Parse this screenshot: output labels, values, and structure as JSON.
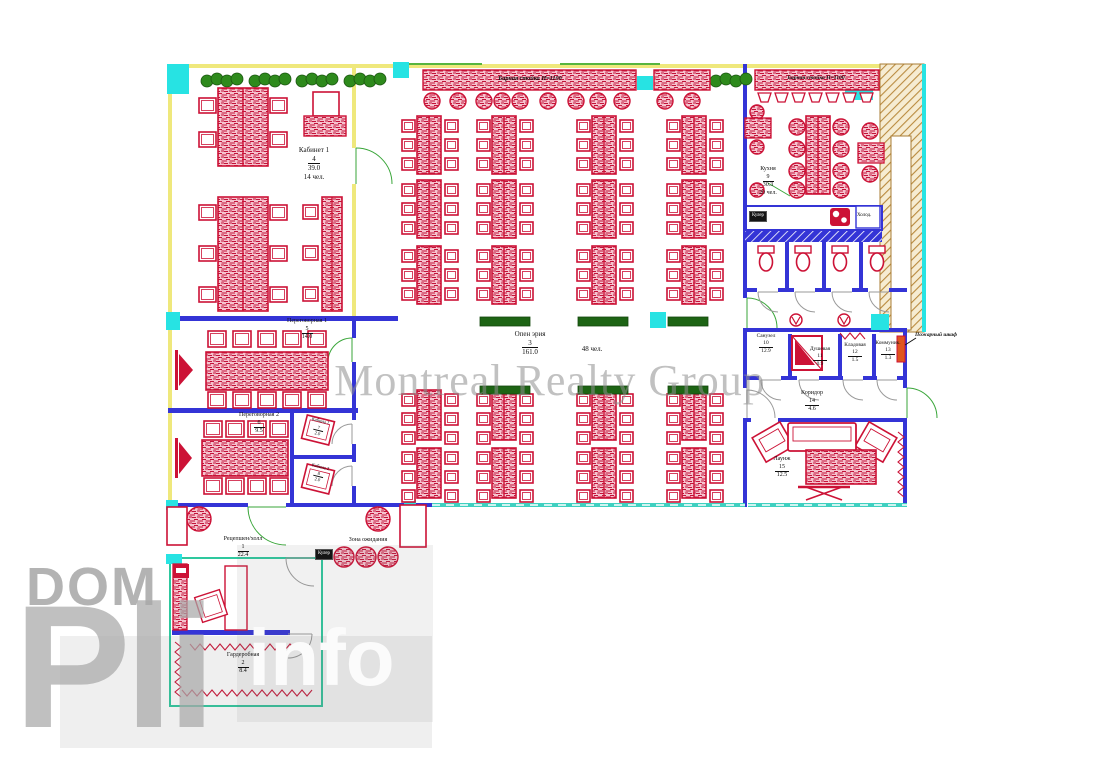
{
  "watermarks": {
    "center": "Montreal Realty Group",
    "dom": "DOM",
    "big_letters": "Pli",
    "info": "info"
  },
  "rooms": {
    "reception": {
      "name": "Рецепшен/холл",
      "num": "1",
      "area": "22.4"
    },
    "wardrobe": {
      "name": "Гардеробная",
      "num": "2",
      "area": "8.4"
    },
    "open_area": {
      "name": "Опен эрия",
      "num": "3",
      "area": "161.0",
      "cap": "48 чел."
    },
    "office1": {
      "name": "Кабинет 1",
      "num": "4",
      "area": "39.0",
      "cap": "14 чел."
    },
    "meeting1": {
      "name": "Переговорная 1",
      "num": "5",
      "area": "14.0"
    },
    "meeting2": {
      "name": "Переговорная 2",
      "num": "6",
      "area": "9.5"
    },
    "booth1": {
      "name": "Кабина 1",
      "num": "7",
      "area": "2.0"
    },
    "booth2": {
      "name": "Кабина 2",
      "num": "8",
      "area": "2.0"
    },
    "kitchen": {
      "name": "Кухня",
      "num": "9",
      "area": "30.3",
      "cap": "20 чел."
    },
    "bathroom": {
      "name": "Санузел",
      "num": "10",
      "area": "12.9"
    },
    "shower": {
      "name": "Душевая",
      "num": "11",
      "area": "0.9"
    },
    "storage": {
      "name": "Кладовая",
      "num": "12",
      "area": "1.5"
    },
    "comms": {
      "name": "Коммуник.",
      "num": "13",
      "area": "1.3"
    },
    "corridor": {
      "name": "Коридор",
      "num": "14",
      "area": "4.6"
    },
    "lounge": {
      "name": "Лаунж",
      "num": "15",
      "area": "12.5"
    },
    "waiting": {
      "name": "Зона ожидания"
    }
  },
  "annotations": {
    "bar_counter": "Барная стойка Н=1100",
    "fire_cabinet": "Пожарный шкаф",
    "cooler": "Кулер",
    "fridge": "Холод."
  },
  "colors": {
    "furniture_red": "#cc1236",
    "furniture_pink": "#f6c3ce",
    "wall_blue": "#3434d6",
    "wall_yellow": "#efe87c",
    "accent_cyan": "#27e3e3",
    "window_teal": "#3fd0c0",
    "door_green": "#3aa63a",
    "shaft_brown": "#b98a3e",
    "plant_green": "#2e8a1c",
    "fire_orange": "#e0551e",
    "watermark_gray": "#a9a9a9"
  }
}
